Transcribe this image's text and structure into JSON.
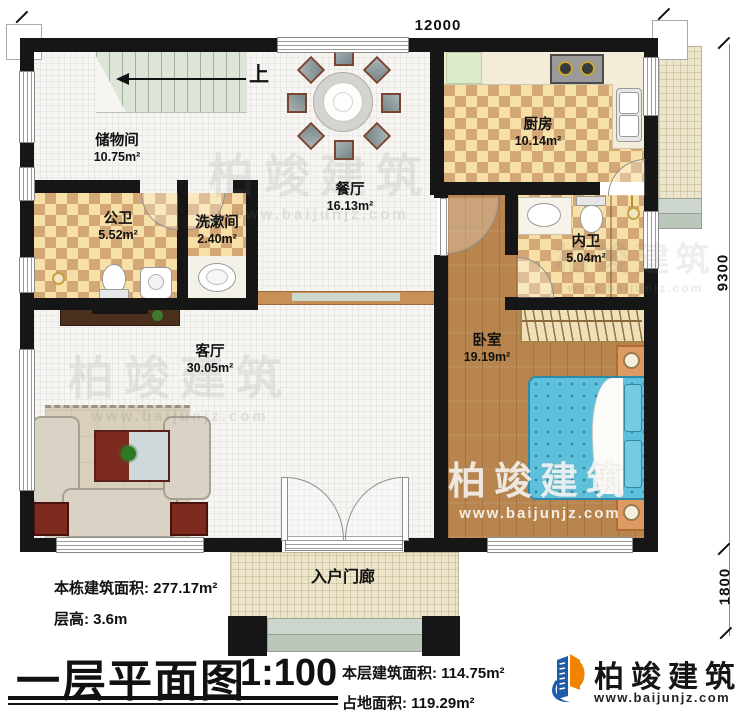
{
  "plan": {
    "dim_top": "12000",
    "dim_right_upper": "9300",
    "dim_right_lower": "1800",
    "stairs_up": "上",
    "rooms": [
      {
        "name": "储物间",
        "area": "10.75m²"
      },
      {
        "name": "餐厅",
        "area": "16.13m²"
      },
      {
        "name": "厨房",
        "area": "10.14m²"
      },
      {
        "name": "公卫",
        "area": "5.52m²"
      },
      {
        "name": "洗漱间",
        "area": "2.40m²"
      },
      {
        "name": "内卫",
        "area": "5.04m²"
      },
      {
        "name": "卧室",
        "area": "19.19m²"
      },
      {
        "name": "客厅",
        "area": "30.05m²"
      },
      {
        "name": "入户门廊",
        "area": ""
      }
    ]
  },
  "title_block": {
    "building_total_area": "本栋建筑面积: 277.17m²",
    "floor_height": "层高: 3.6m",
    "plan_title": "一层平面图",
    "scale": "1:100",
    "floor_area": "本层建筑面积: 114.75m²",
    "footprint_area": "占地面积: 119.29m²"
  },
  "branding": {
    "company": "柏竣建筑",
    "website": "www.baijunjz.com"
  },
  "watermark": {
    "company": "柏竣建筑",
    "website": "www.baijunjz.com"
  },
  "colors": {
    "wall": "#161616",
    "tile_light": "#f7dfa8",
    "tile_dark": "#d3a876",
    "wood_floor": "#b8854e",
    "bed_blue": "#5ec1dc",
    "porch_tile": "#ece5cb",
    "stair_tread": "#dce5d8",
    "logo_blue": "#1c5ca8",
    "logo_orange": "#f08300"
  }
}
